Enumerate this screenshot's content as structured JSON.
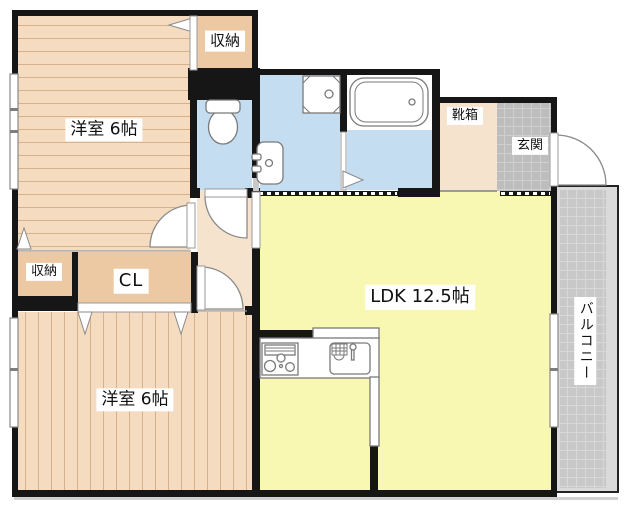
{
  "labels": {
    "west_room_top": "洋室 6帖",
    "closet_top": "収納",
    "closet_left": "収納",
    "closet_cl": "CL",
    "west_room_bottom": "洋室 6帖",
    "ldk": "LDK 12.5帖",
    "shoe_box": "靴箱",
    "entrance": "玄関",
    "balcony": "バルコニー"
  },
  "colors": {
    "wall": "#161616",
    "wood_floor": "#F5DBC0",
    "plank_line": "#D6B28C",
    "closet_fill": "#ECC9A2",
    "hall_fill": "#F6E3CD",
    "wet_area_fill": "#C4DDF1",
    "ldk_fill": "#F8F8B2",
    "entrance_tile": "#BDBDBD",
    "entrance_tile_line": "#CFCFCF",
    "balcony_tile": "#C8C8C8",
    "balcony_tile_line": "#D8D8D8",
    "balcony_margin": "#DADADA",
    "fixture_stroke": "#7A7A7A"
  }
}
